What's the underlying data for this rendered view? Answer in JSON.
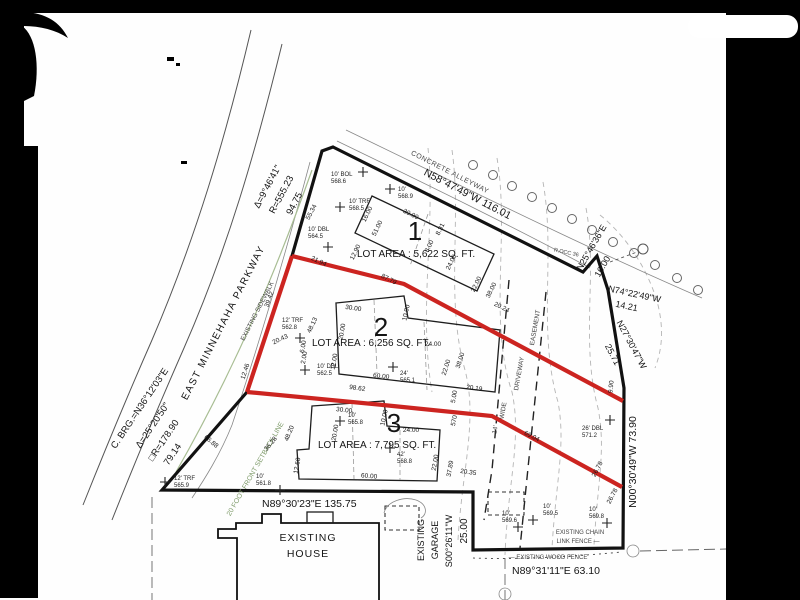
{
  "drawing": {
    "street": "EAST MINNEHAHA PARKWAY",
    "curve1": {
      "delta": "Δ=9°46'41\"",
      "radius": "R=555.23",
      "length": "94.75"
    },
    "curve2": {
      "chord": "C. BRG.=N36°12'03\"E",
      "delta": "Δ=25°20'50\"",
      "radius": "□R=178.90",
      "length": "79.14"
    },
    "bearings": {
      "alley": "N58°47'49\"W  116.01",
      "ne1": "N25°46'36\"E",
      "ne1_len": "16.00",
      "ne2": "N74°22'49\"W",
      "ne2_len": "14.21",
      "ne3": "N27°30'47\"W",
      "ne3_len": "25.71",
      "east": "N00°30'49\"W  73.90",
      "south": "N89°30'23\"E  135.75",
      "south_east": "N89°31'11\"E  63.10",
      "garage_side": "S00°26'11\"W",
      "garage_len": "25.00"
    },
    "labels": {
      "alleyway": "CONCRETE ALLEYWAY",
      "sidewalk": "EXISTING SIDEWALK",
      "setback": "20 FOOT FRONT SETBACK LINE",
      "house1": "EXISTING",
      "house2": "HOUSE",
      "garage1": "EXISTING",
      "garage2": "GARAGE",
      "chain1": "EXISTING CHAIN",
      "chain2": "LINK FENCE —",
      "wood": "— EXISTING WOOD FENCE",
      "drv1": "14'",
      "drv2": "WIDE",
      "drv3": "DRIVEWAY",
      "drv4": "EASEMENT",
      "poc": "R.OCC 36"
    },
    "lots": [
      {
        "num": "1",
        "area": "LOT AREA : 5,622 SQ. FT."
      },
      {
        "num": "2",
        "area": "LOT AREA : 6,256 SQ. FT."
      },
      {
        "num": "3",
        "area": "LOT AREA : 7,795 SQ. FT."
      }
    ],
    "dimensions": [
      {
        "t": "55.34",
        "x": 313,
        "y": 213,
        "r": -62
      },
      {
        "t": "21.94",
        "x": 318,
        "y": 263,
        "r": 25
      },
      {
        "t": "87.79",
        "x": 388,
        "y": 281,
        "r": 27
      },
      {
        "t": "39.42",
        "x": 271,
        "y": 300,
        "r": -70
      },
      {
        "t": "48.13",
        "x": 314,
        "y": 326,
        "r": -65
      },
      {
        "t": "20.43",
        "x": 281,
        "y": 341,
        "r": -25
      },
      {
        "t": "12.46",
        "x": 247,
        "y": 372,
        "r": -72
      },
      {
        "t": "66.88",
        "x": 210,
        "y": 443,
        "r": 40
      },
      {
        "t": "48.20",
        "x": 291,
        "y": 434,
        "r": -68
      },
      {
        "t": "36.28",
        "x": 272,
        "y": 445,
        "r": -50
      },
      {
        "t": "98.62",
        "x": 357,
        "y": 390,
        "r": 8
      },
      {
        "t": "69.04",
        "x": 531,
        "y": 438,
        "r": 27
      },
      {
        "t": "16.00",
        "x": 369,
        "y": 215,
        "r": -64
      },
      {
        "t": "51.00",
        "x": 379,
        "y": 229,
        "r": -64
      },
      {
        "t": "30.00",
        "x": 410,
        "y": 216,
        "r": 26
      },
      {
        "t": "12.90",
        "x": 357,
        "y": 253,
        "r": -64
      },
      {
        "t": "8.00",
        "x": 431,
        "y": 247,
        "r": -64
      },
      {
        "t": "8.31",
        "x": 442,
        "y": 230,
        "r": -64
      },
      {
        "t": "24.00",
        "x": 453,
        "y": 263,
        "r": -64
      },
      {
        "t": "22.00",
        "x": 478,
        "y": 285,
        "r": -64
      },
      {
        "t": "38.00",
        "x": 493,
        "y": 291,
        "r": -64
      },
      {
        "t": "20.24",
        "x": 501,
        "y": 309,
        "r": 26
      },
      {
        "t": "30.00",
        "x": 353,
        "y": 310,
        "r": 8
      },
      {
        "t": "20.00",
        "x": 344,
        "y": 332,
        "r": -80
      },
      {
        "t": "10.00",
        "x": 408,
        "y": 313,
        "r": -78
      },
      {
        "t": "24.00",
        "x": 433,
        "y": 346,
        "r": 0
      },
      {
        "t": "12.00",
        "x": 336,
        "y": 362,
        "r": -80
      },
      {
        "t": "6.00",
        "x": 305,
        "y": 347,
        "r": -80
      },
      {
        "t": "2.00",
        "x": 306,
        "y": 358,
        "r": -80
      },
      {
        "t": "60.00",
        "x": 381,
        "y": 378,
        "r": 7
      },
      {
        "t": "22.00",
        "x": 448,
        "y": 368,
        "r": -72
      },
      {
        "t": "38.00",
        "x": 462,
        "y": 361,
        "r": -72
      },
      {
        "t": "20.19",
        "x": 474,
        "y": 390,
        "r": 8
      },
      {
        "t": "5.00",
        "x": 456,
        "y": 397,
        "r": -80
      },
      {
        "t": "570",
        "x": 456,
        "y": 421,
        "r": -78
      },
      {
        "t": "30.00",
        "x": 344,
        "y": 412,
        "r": 6
      },
      {
        "t": "20.00",
        "x": 337,
        "y": 433,
        "r": -80
      },
      {
        "t": "10.00",
        "x": 386,
        "y": 418,
        "r": -78
      },
      {
        "t": "24.00",
        "x": 411,
        "y": 432,
        "r": 0
      },
      {
        "t": "22.00",
        "x": 437,
        "y": 463,
        "r": -80
      },
      {
        "t": "60.00",
        "x": 369,
        "y": 478,
        "r": 4
      },
      {
        "t": "12.60",
        "x": 299,
        "y": 466,
        "r": -80
      },
      {
        "t": "37.89",
        "x": 452,
        "y": 469,
        "r": -80
      },
      {
        "t": "20.35",
        "x": 468,
        "y": 474,
        "r": 8
      },
      {
        "t": "9.90",
        "x": 613,
        "y": 387,
        "r": -84
      },
      {
        "t": "26.78",
        "x": 599,
        "y": 470,
        "r": -62
      },
      {
        "t": "26.78",
        "x": 614,
        "y": 497,
        "r": -62
      }
    ],
    "trees": [
      {
        "x": 363,
        "y": 172,
        "dx": -32,
        "dy": 4,
        "l1": "10' BOL",
        "l2": "568.6"
      },
      {
        "x": 390,
        "y": 189,
        "dx": 8,
        "dy": 2,
        "l1": "10'",
        "l2": "568.9"
      },
      {
        "x": 340,
        "y": 207,
        "dx": 9,
        "dy": -4,
        "l1": "10' TRF",
        "l2": "568.5"
      },
      {
        "x": 328,
        "y": 247,
        "dx": -20,
        "dy": -16,
        "l1": "10' DBL",
        "l2": "564.5"
      },
      {
        "x": 300,
        "y": 338,
        "dx": -18,
        "dy": -16,
        "l1": "12' TRF",
        "l2": "562.8"
      },
      {
        "x": 305,
        "y": 370,
        "dx": 12,
        "dy": -2,
        "l1": "10' DBL",
        "l2": "562.5"
      },
      {
        "x": 393,
        "y": 367,
        "dx": 7,
        "dy": 8,
        "l1": "24'",
        "l2": "565.1"
      },
      {
        "x": 340,
        "y": 421,
        "dx": 8,
        "dy": -4,
        "l1": "10'",
        "l2": "565.8"
      },
      {
        "x": 390,
        "y": 448,
        "dx": 7,
        "dy": 8,
        "l1": "42'",
        "l2": "568.8"
      },
      {
        "x": 165,
        "y": 482,
        "dx": 9,
        "dy": -2,
        "l1": "12' TRF",
        "l2": "565.9"
      },
      {
        "x": 280,
        "y": 490,
        "dx": -24,
        "dy": -12,
        "l1": "10'",
        "l2": "561.8"
      },
      {
        "x": 610,
        "y": 420,
        "dx": -28,
        "dy": 10,
        "l1": "26' DBL",
        "l2": "571.2"
      },
      {
        "x": 533,
        "y": 520,
        "dx": 10,
        "dy": -12,
        "l1": "10'",
        "l2": "569.5"
      },
      {
        "x": 518,
        "y": 527,
        "dx": -16,
        "dy": -12,
        "l1": "10'",
        "l2": "569.6"
      },
      {
        "x": 607,
        "y": 523,
        "dx": -18,
        "dy": -12,
        "l1": "10'",
        "l2": "569.8"
      }
    ],
    "colors": {
      "highlight": "#cc2420",
      "setback_green": "#a8bd93",
      "paper": "#ffffff",
      "frame": "#000000"
    }
  }
}
